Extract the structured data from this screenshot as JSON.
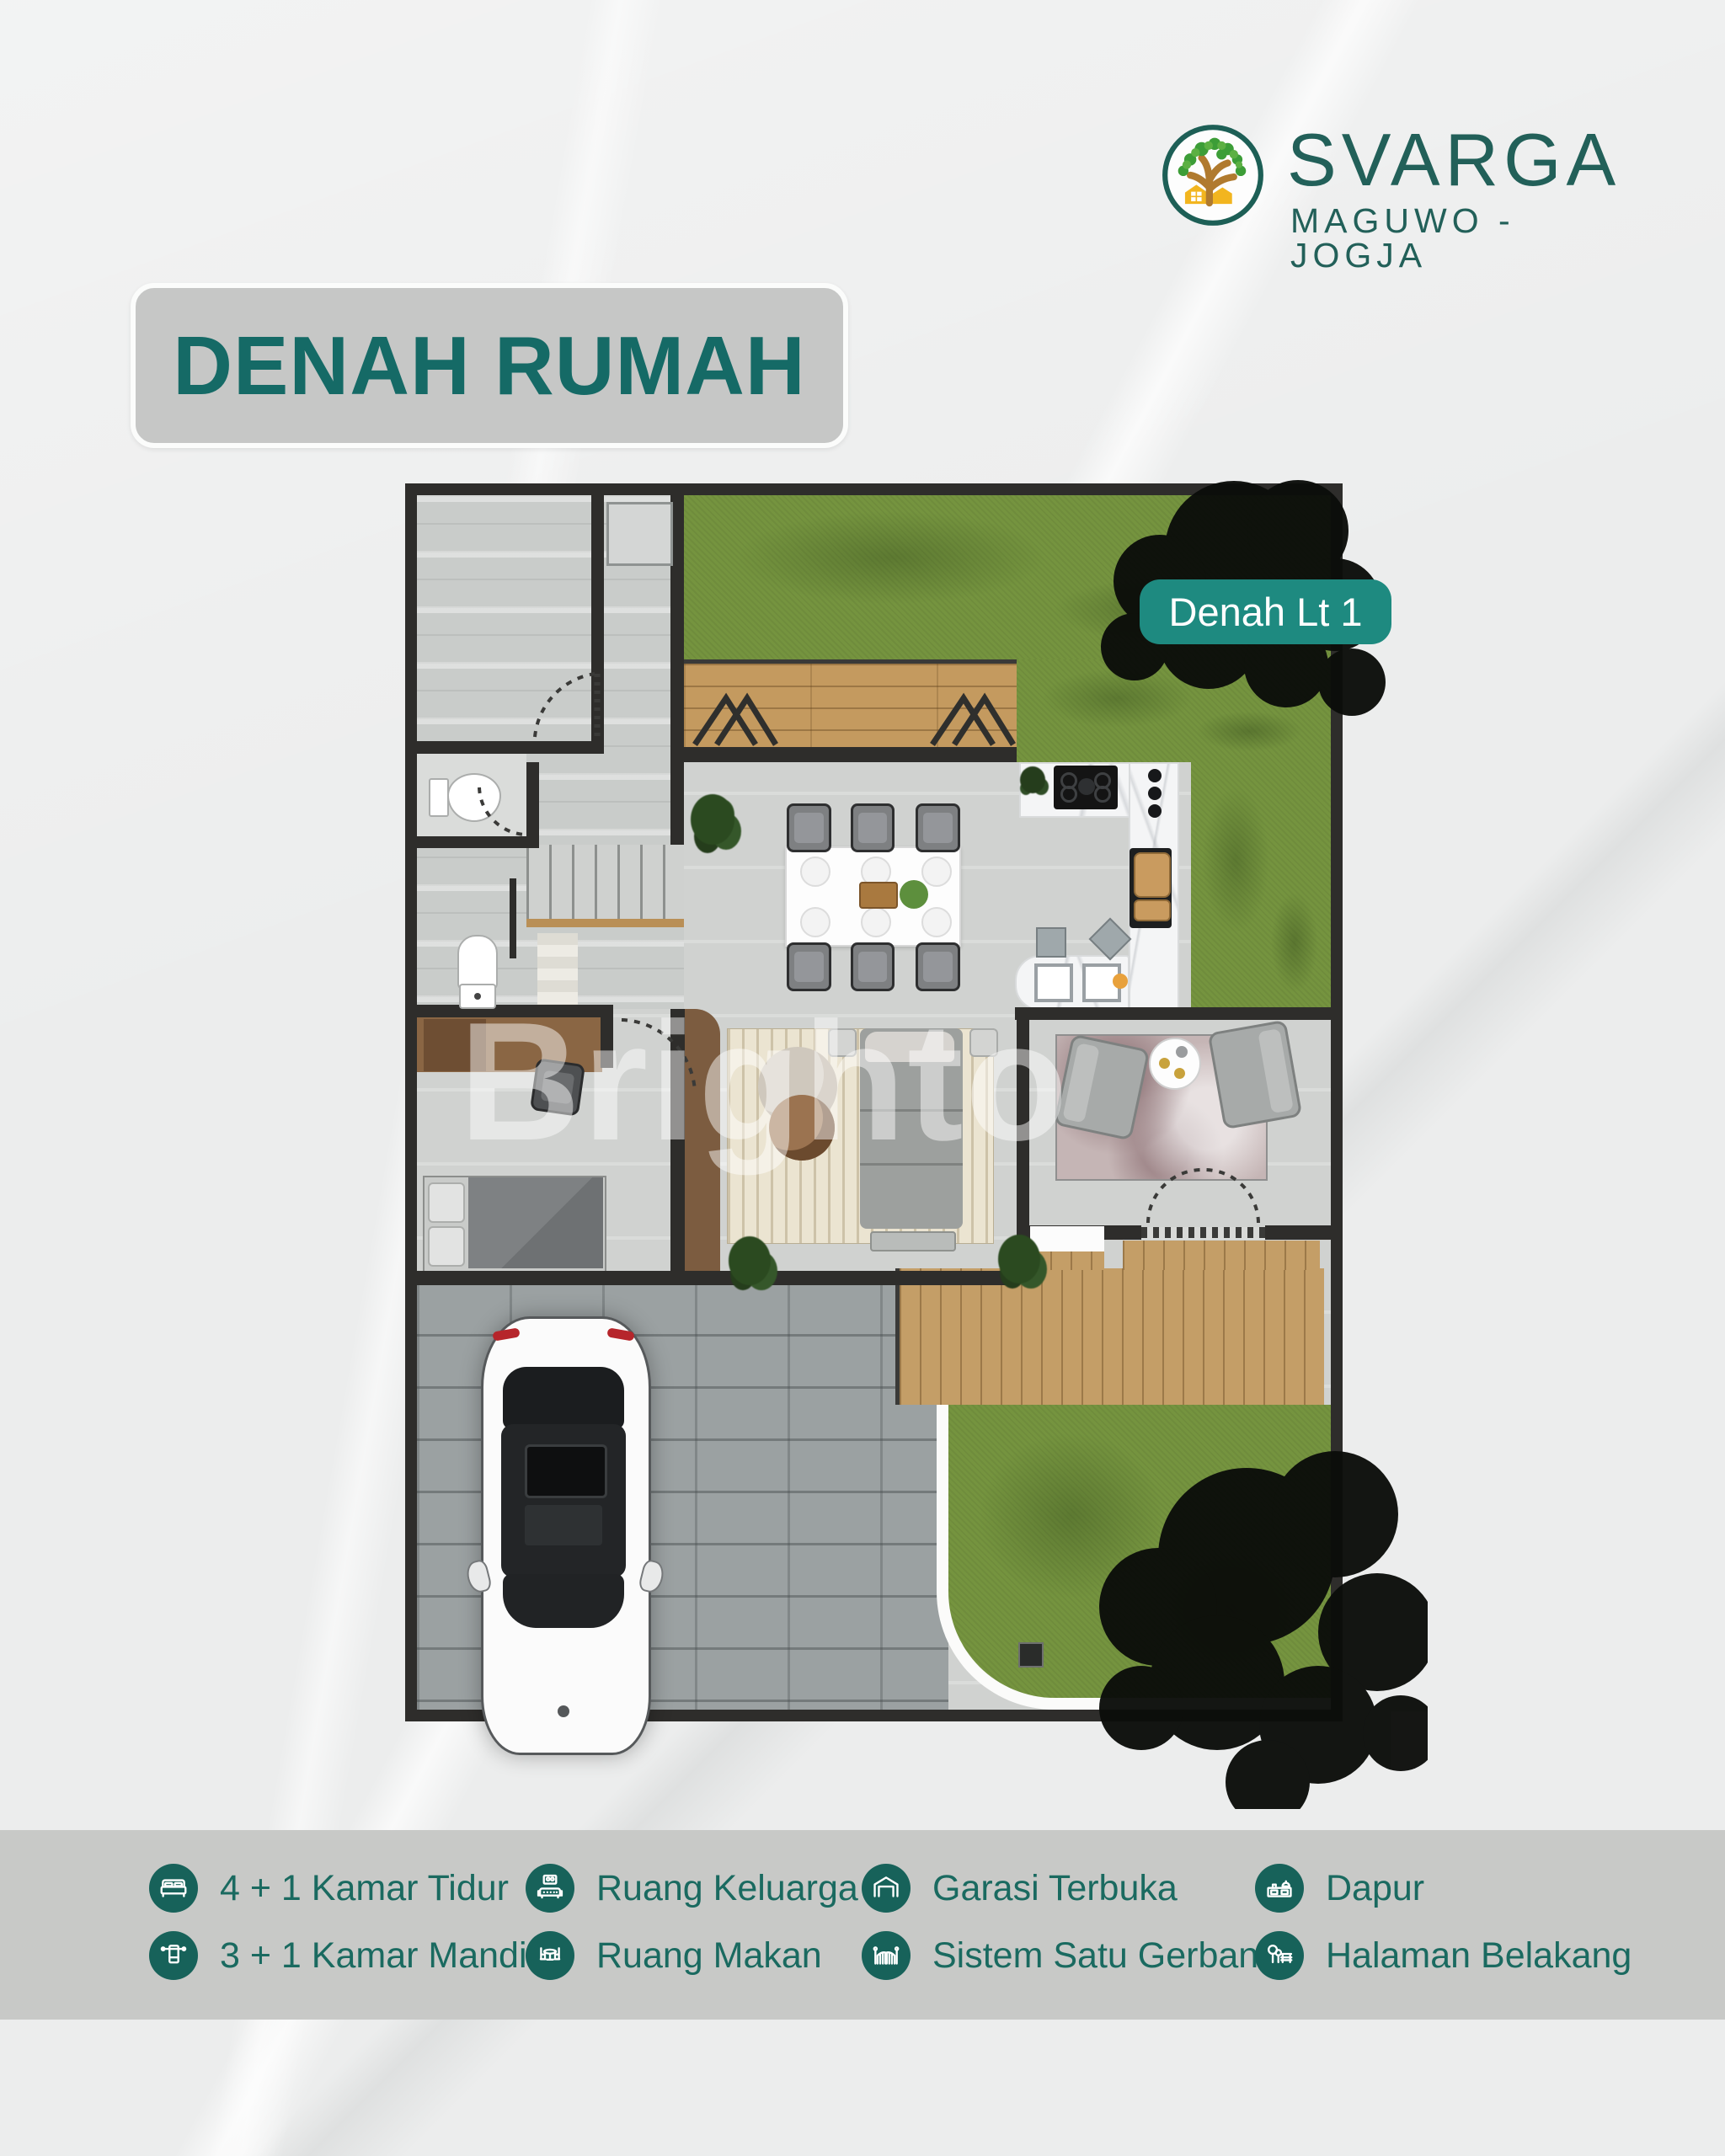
{
  "theme": {
    "teal_dark": "#17625A",
    "teal_text": "#1A6A60",
    "teal_badge": "#1E8A80",
    "logo_teal": "#226059",
    "title_color": "#156A66",
    "band_bg": "#C8C9C7",
    "title_box_bg": "#C6C7C6",
    "page_bg": "#ECEDED"
  },
  "header": {
    "brand": "SVARGA",
    "location": "MAGUWO - JOGJA"
  },
  "title": {
    "text": "DENAH RUMAH"
  },
  "plan": {
    "badge_label": "Denah Lt 1",
    "watermark": "Brighto"
  },
  "legend": {
    "items": [
      {
        "icon": "bed-icon",
        "label": "4 + 1 Kamar Tidur"
      },
      {
        "icon": "bathroom-icon",
        "label": "3 + 1 Kamar Mandi"
      },
      {
        "icon": "family-room-icon",
        "label": "Ruang Keluarga"
      },
      {
        "icon": "dining-room-icon",
        "label": "Ruang Makan"
      },
      {
        "icon": "garage-icon",
        "label": "Garasi Terbuka"
      },
      {
        "icon": "gate-icon",
        "label": "Sistem Satu Gerbang"
      },
      {
        "icon": "kitchen-icon",
        "label": "Dapur"
      },
      {
        "icon": "backyard-icon",
        "label": "Halaman Belakang"
      }
    ]
  }
}
